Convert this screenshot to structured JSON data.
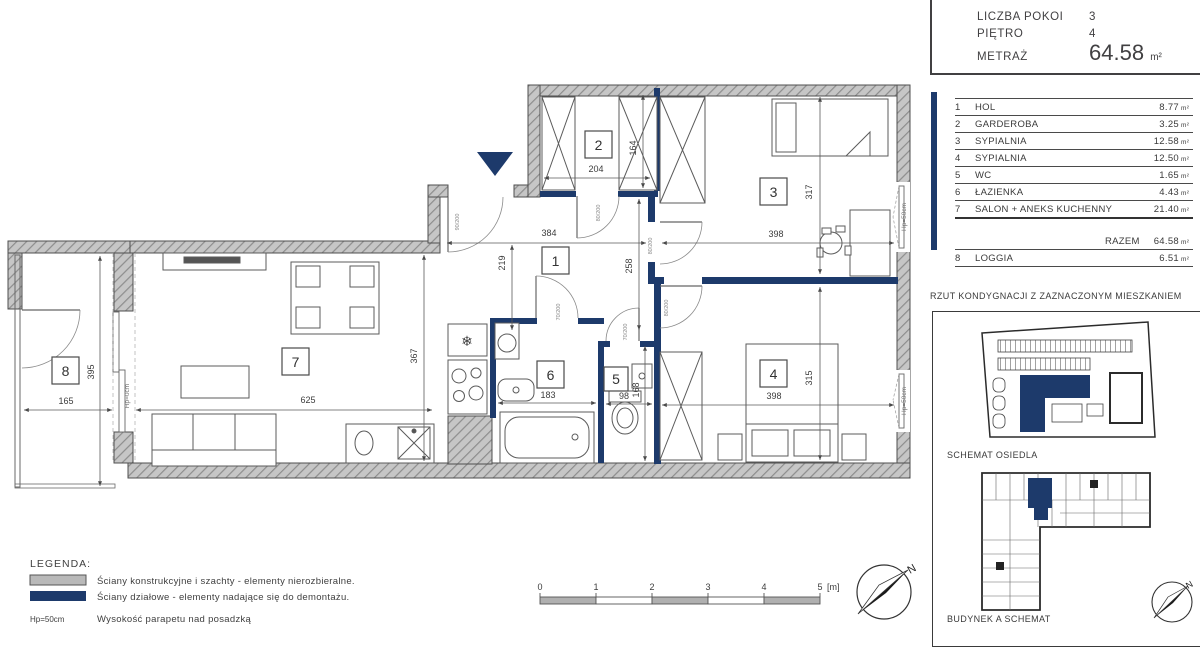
{
  "header": {
    "rows": [
      {
        "label": "LICZBA POKOI",
        "value": "3"
      },
      {
        "label": "PIĘTRO",
        "value": "4"
      }
    ],
    "area_label": "METRAŻ",
    "area_value": "64.58",
    "area_unit": "m²"
  },
  "room_table": {
    "rows": [
      {
        "no": "1",
        "name": "HOL",
        "area": "8.77",
        "unit": "m²"
      },
      {
        "no": "2",
        "name": "GARDEROBA",
        "area": "3.25",
        "unit": "m²"
      },
      {
        "no": "3",
        "name": "SYPIALNIA",
        "area": "12.58",
        "unit": "m²"
      },
      {
        "no": "4",
        "name": "SYPIALNIA",
        "area": "12.50",
        "unit": "m²"
      },
      {
        "no": "5",
        "name": "WC",
        "area": "1.65",
        "unit": "m²"
      },
      {
        "no": "6",
        "name": "ŁAZIENKA",
        "area": "4.43",
        "unit": "m²"
      },
      {
        "no": "7",
        "name": "SALON + ANEKS KUCHENNY",
        "area": "21.40",
        "unit": "m²"
      }
    ],
    "total_label": "RAZEM",
    "total_area": "64.58",
    "total_unit": "m²",
    "loggia_row": {
      "no": "8",
      "name": "LOGGIA",
      "area": "6.51",
      "unit": "m²"
    }
  },
  "captions": {
    "floor_plan": "RZUT KONDYGNACJI Z ZAZNACZONYM MIESZKANIEM",
    "estate": "SCHEMAT OSIEDLA",
    "building": "BUDYNEK A SCHEMAT"
  },
  "legend": {
    "title": "LEGENDA:",
    "item_structural": "Ściany konstrukcyjne i szachty - elementy nierozbieralne.",
    "item_partition": "Ściany działowe - elementy nadające się do demontażu.",
    "note_key": "Hp=50cm",
    "note_text": "Wysokość parapetu nad posadzką"
  },
  "scalebar": {
    "t0": "0",
    "t1": "1",
    "t2": "2",
    "t3": "3",
    "t4": "4",
    "t5": "5",
    "unit": "[m]"
  },
  "compass": {
    "north": "N"
  },
  "plan": {
    "rooms": {
      "r1": "1",
      "r2": "2",
      "r3": "3",
      "r4": "4",
      "r5": "5",
      "r6": "6",
      "r7": "7",
      "r8": "8"
    },
    "dims": {
      "room2_w": "204",
      "room2_h": "164",
      "hall_w": "384",
      "hall_h1": "219",
      "hall_h2": "258",
      "room3_w": "398",
      "room3_h": "317",
      "room4_w": "398",
      "room4_h": "315",
      "salon_w": "625",
      "salon_h": "367",
      "loggia_w": "165",
      "loggia_h": "395",
      "bath_w": "183",
      "wc_w": "98",
      "wc_h": "168"
    },
    "door_labels": {
      "entrance": "90/200",
      "bedroom": "80/200",
      "garderoba": "80/200",
      "bath": "70/200",
      "wc": "70/200"
    },
    "window_labels": {
      "hp50": "Hp=50cm",
      "hp0": "Hp=0cm"
    }
  },
  "colors": {
    "accent": "#1d3a6b",
    "wall": "#c2c2c2"
  }
}
